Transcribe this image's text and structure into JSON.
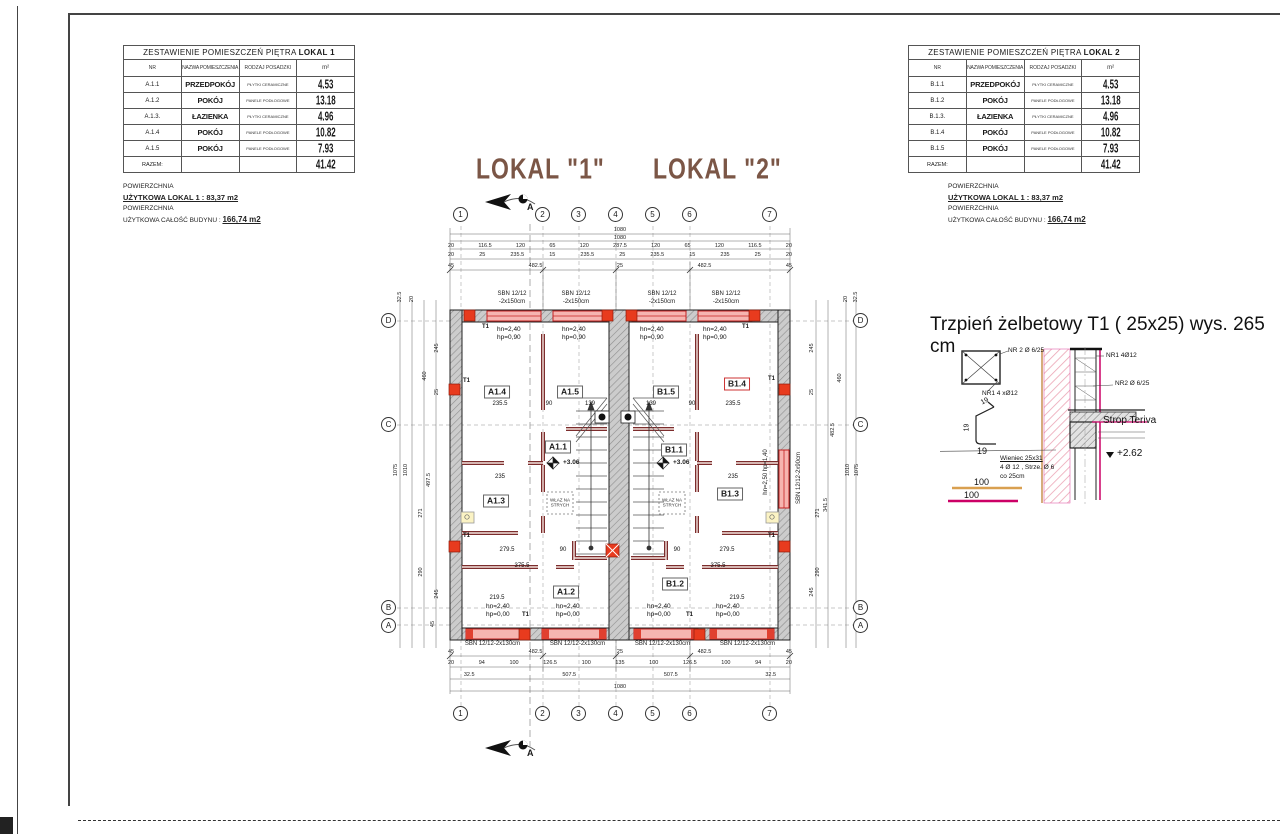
{
  "tables": {
    "lokal1": {
      "title": "ZESTAWIENIE POMIESZCZEŃ PIĘTRA",
      "title_bold": "LOKAL 1",
      "headers": {
        "nr": "NR",
        "name": "NAZWA POMIESZCZENIA",
        "floor": "RODZAJ POSADZKI",
        "area": "m²"
      },
      "rows": [
        {
          "nr": "A.1.1",
          "name": "PRZEDPOKÓJ",
          "floor": "PŁYTKI CERAMICZNE",
          "area": "4.53"
        },
        {
          "nr": "A.1.2",
          "name": "POKÓJ",
          "floor": "PANELE PODŁOGOWE",
          "area": "13.18"
        },
        {
          "nr": "A.1.3.",
          "name": "ŁAZIENKA",
          "floor": "PŁYTKI CERAMICZNE",
          "area": "4.96"
        },
        {
          "nr": "A.1.4",
          "name": "POKÓJ",
          "floor": "PANELE PODŁOGOWE",
          "area": "10.82"
        },
        {
          "nr": "A.1.5",
          "name": "POKÓJ",
          "floor": "PANELE PODŁOGOWE",
          "area": "7.93"
        }
      ],
      "total_label": "RAZEM:",
      "total": "41.42"
    },
    "lokal2": {
      "title": "ZESTAWIENIE POMIESZCZEŃ PIĘTRA",
      "title_bold": "LOKAL 2",
      "headers": {
        "nr": "NR",
        "name": "NAZWA POMIESZCZENIA",
        "floor": "RODZAJ POSADZKI",
        "area": "m²"
      },
      "rows": [
        {
          "nr": "B.1.1",
          "name": "PRZEDPOKÓJ",
          "floor": "PŁYTKI CERAMICZNE",
          "area": "4.53"
        },
        {
          "nr": "B.1.2",
          "name": "POKÓJ",
          "floor": "PANELE PODŁOGOWE",
          "area": "13.18"
        },
        {
          "nr": "B.1.3.",
          "name": "ŁAZIENKA",
          "floor": "PŁYTKI CERAMICZNE",
          "area": "4.96"
        },
        {
          "nr": "B.1.4",
          "name": "POKÓJ",
          "floor": "PANELE PODŁOGOWE",
          "area": "10.82"
        },
        {
          "nr": "B.1.5",
          "name": "POKÓJ",
          "floor": "PANELE PODŁOGOWE",
          "area": "7.93"
        }
      ],
      "total_label": "RAZEM:",
      "total": "41.42"
    }
  },
  "notes": {
    "left": {
      "l1": "POWIERZCHNIA",
      "l2": "UŻYTKOWA LOKAL 1  : 83,37 m2",
      "l3": "POWIERZCHNIA",
      "l4a": "UŻYTKOWA CAŁOŚĆ BUDYNU : ",
      "l4b": "166,74 m2"
    },
    "right": {
      "l1": "POWIERZCHNIA",
      "l2": "UŻYTKOWA LOKAL 1  : 83,37 m2",
      "l3": "POWIERZCHNIA",
      "l4a": "UŻYTKOWA CAŁOŚĆ BUDYNU : ",
      "l4b": "166,74 m2"
    }
  },
  "titles": {
    "left": "LOKAL \"1\"",
    "right": "LOKAL \"2\""
  },
  "section": {
    "label": "A"
  },
  "grid": {
    "cols": [
      "1",
      "2",
      "3",
      "4",
      "5",
      "6",
      "7"
    ],
    "rows": [
      "D",
      "C",
      "B",
      "A"
    ]
  },
  "dims": {
    "top1": "1080",
    "top2": "1080",
    "top3": [
      "20",
      "116.5",
      "120",
      "65",
      "120",
      "287.5",
      "120",
      "65",
      "120",
      "116.5",
      "20"
    ],
    "top4": [
      "20",
      "25",
      "235.5",
      "15",
      "235.5",
      "25",
      "235.5",
      "15",
      "235",
      "25",
      "20"
    ],
    "top5": [
      "45",
      "482.5",
      "25",
      "482.5",
      "45"
    ],
    "bot1": [
      "45",
      "482.5",
      "25",
      "482.5",
      "45"
    ],
    "bot2": [
      "20",
      "94",
      "100",
      "126.5",
      "100",
      "135",
      "100",
      "126.5",
      "100",
      "94",
      "20"
    ],
    "bot3": [
      "32.5",
      "507.5",
      "507.5",
      "32.5"
    ],
    "bot_total": "1080",
    "left": [
      "32.5",
      "20",
      "245",
      "460",
      "25",
      "1075",
      "1010",
      "497.5",
      "271",
      "290",
      "245",
      "45"
    ],
    "right": [
      "20",
      "32.5",
      "245",
      "460",
      "25",
      "482.5",
      "341.5",
      "271",
      "290",
      "245",
      "1010",
      "1075"
    ]
  },
  "win": {
    "top_l1": "SBN 12/12",
    "top_l2": "-2x150cm",
    "top_ann": "hn=2,40\nhp=0,90",
    "bot_labels": [
      "SBN 12/12-2x130cm",
      "SBN 12/12-2x130cm",
      "SBN 12/12-2x130cm",
      "SBN 12/12-2x130cm"
    ],
    "bot_ann": "hn=2,40\nhp=0,00",
    "right_label": "SBN 12/12-2x90cm",
    "right_ann": "hn=2,50  hp=1,40"
  },
  "rooms": {
    "a14": "A1.4",
    "a15": "A1.5",
    "b15": "B1.5",
    "b14": "B1.4",
    "a11": "A1.1",
    "b11": "B1.1",
    "a13": "A1.3",
    "b13": "B1.3",
    "a12": "A1.2",
    "b12": "B1.2"
  },
  "pdims": {
    "t0": "235.5",
    "t1": "90",
    "t2": "139",
    "t3": "139",
    "t4": "90",
    "t5": "235.5",
    "m0": "235",
    "m1": "235",
    "l0": "279.5",
    "l1": "90",
    "l2": "90",
    "l3": "279.5",
    "b0": "375.5",
    "b1": "375.5",
    "b2": "219.5",
    "b3": "219.5"
  },
  "level": "+3.06",
  "wlaz": "WŁAZ NA\nSTRYCH",
  "t1": "T1",
  "detail": {
    "title": "Trzpień żelbetowy T1 ( 25x25) wys. 265 cm",
    "bar_top": "NR 2 Ø 6/25",
    "bar_main": "NR1 4 xØ12",
    "lbl_nr1": "NR1 4Ø12",
    "lbl_nr2": "NR2 Ø 6/25",
    "strop": "Strop Teriva",
    "level": "+2.62",
    "wieniec1": "Wieniec 25x31",
    "wieniec2": "4 Ø 12 , Strze. Ø 6",
    "wieniec3": "co 25cm",
    "s19a": "19",
    "s19b": "19",
    "s19c": "19",
    "scale1": "100",
    "scale2": "100"
  }
}
